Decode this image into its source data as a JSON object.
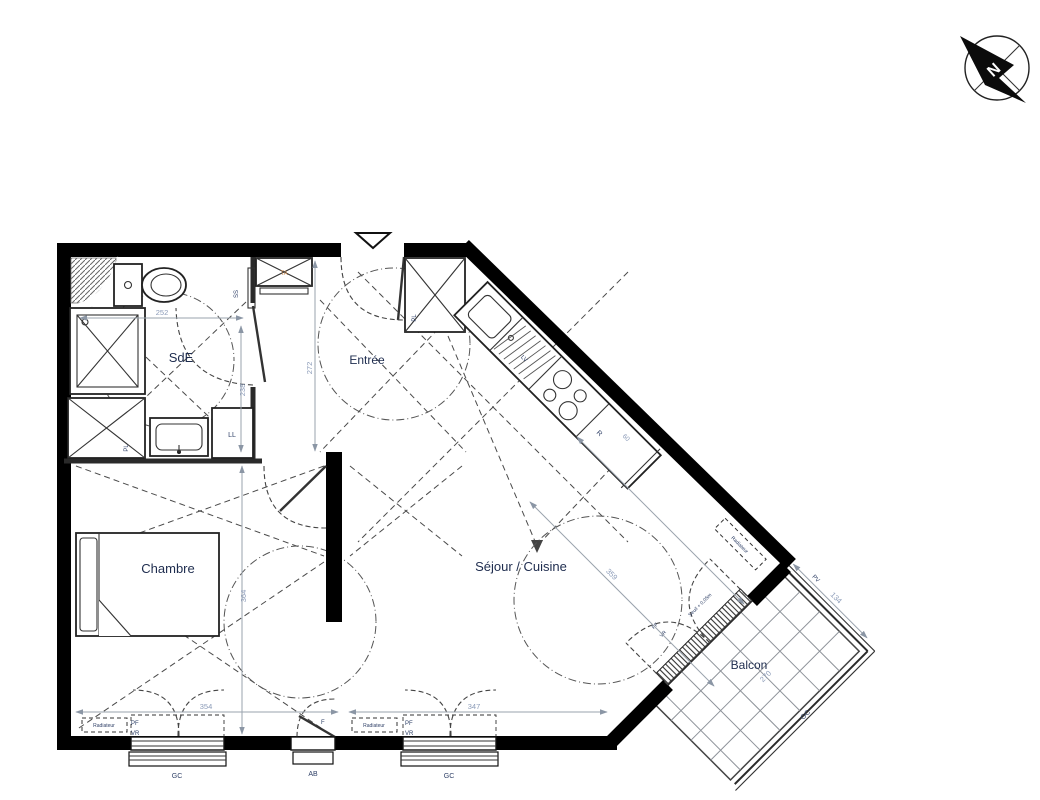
{
  "compass": {
    "north": "N"
  },
  "rooms": {
    "sde": "SdE",
    "entree": "Entrée",
    "chambre": "Chambre",
    "sejour_cuisine": "Séjour / Cuisine",
    "balcon": "Balcon"
  },
  "labels": {
    "closet": "PL",
    "washer": "LL",
    "towel_rail": "SS",
    "tech": "TA",
    "sink": "LV",
    "fridge": "R",
    "radiator": "Radiateur",
    "window_pf": "PF",
    "window_vr": "VR",
    "window_f": "F",
    "rail_gc": "GC",
    "sill_ab": "AB",
    "balcony_pv": "PV",
    "threshold": "Seuil + 0,05m"
  },
  "dims": {
    "sde_w": "252",
    "sde_h": "238",
    "entree_h": "272",
    "chambre_h": "364",
    "chambre_w": "354",
    "sejour_w": "347",
    "sejour_diag": "359",
    "fridge_w": "60",
    "balcon_w": "134",
    "balcon_l": "270"
  }
}
